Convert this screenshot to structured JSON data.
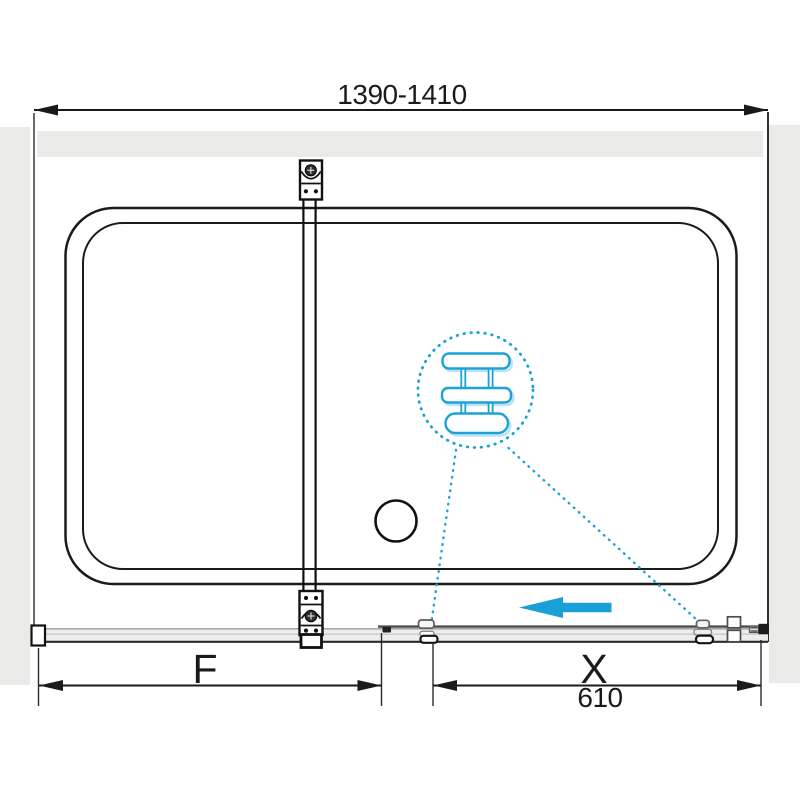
{
  "drawing": {
    "kind": "shower-enclosure-dimension-diagram",
    "labels": {
      "overall_width": "1390-1410",
      "fixed_section": "F",
      "sliding_section": "X",
      "sliding_section_mm": "610"
    },
    "colors": {
      "accent_cyan": "#1ba3d4",
      "accent_cyan_shadow": "#b9e3f3",
      "direction_arrow_blue": "#1b9fd9",
      "wall_gray": "#eaeae8",
      "drawing_line": "#1a1a1a",
      "track_gray": "#ededec"
    }
  }
}
